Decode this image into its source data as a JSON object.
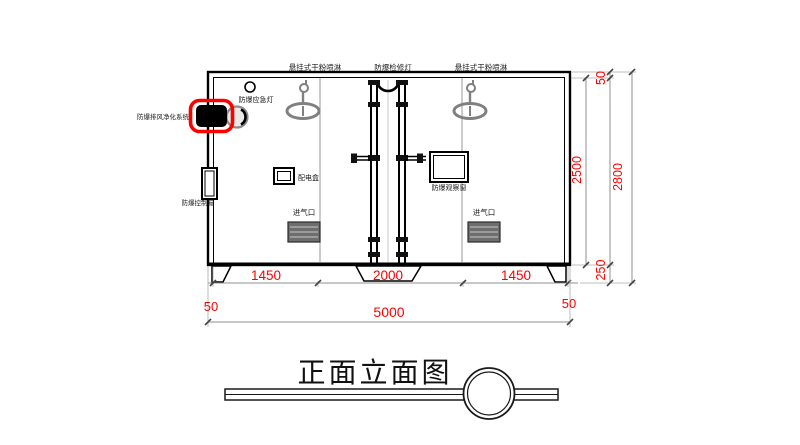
{
  "drawing": {
    "title": "正面立面图",
    "equipment_labels": {
      "sprinkler_left": "悬挂式干粉喷淋",
      "inspection_light": "防爆检修灯",
      "sprinkler_right": "悬挂式干粉喷淋",
      "emergency_light": "防爆应急灯",
      "exhaust_purification_system": "防爆排风净化系统",
      "control_box": "防爆控制箱",
      "distribution_box": "配电盒",
      "observation_window": "防爆观察窗",
      "air_inlet_left": "进气口",
      "air_inlet_right": "进气口"
    },
    "dimensions": {
      "width_left_section": "1450",
      "width_middle_section": "2000",
      "width_right_section": "1450",
      "wall_thickness_left": "50",
      "wall_thickness_right": "50",
      "total_width": "5000",
      "inner_height": "2500",
      "roof_thickness": "50",
      "total_height": "2800",
      "leg_height": "250"
    },
    "colors": {
      "dimension_text": "#ff0000",
      "highlight": "#ff0000",
      "main_line": "#000000",
      "secondary_line": "#808080"
    }
  }
}
